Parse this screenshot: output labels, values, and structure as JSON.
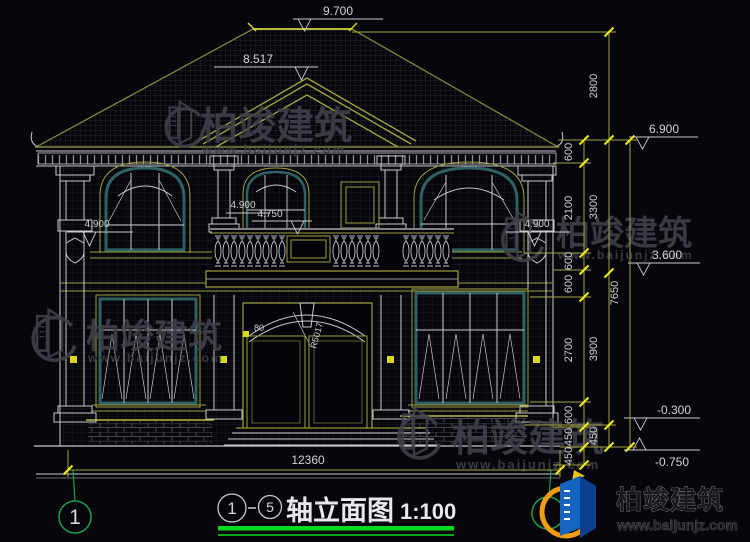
{
  "title_block": {
    "axis_from": "1",
    "axis_to": "5",
    "title": "轴立面图",
    "scale": "1:100"
  },
  "axis_left": "1",
  "elevations": {
    "ridge": "9.700",
    "gable": "8.517",
    "eave": "6.900",
    "sill_left": "4.900",
    "center_upper": "4.900",
    "center_lower": "4.750",
    "sill_right": "4.900",
    "second_floor": "3.600",
    "grade_a": "-0.300",
    "grade_b": "-0.750"
  },
  "dims": {
    "width_total": "12360",
    "roof": "2800",
    "inner": [
      "600",
      "2100",
      "600",
      "600",
      "2700",
      "600",
      "450",
      "450"
    ],
    "mid": [
      "3300",
      "3900",
      "450"
    ],
    "total": "7650",
    "door_radius": "R5017",
    "door_width": "80"
  },
  "watermark": {
    "company": "柏竣建筑",
    "website": "www.baijunjz.com"
  },
  "brand": {
    "company": "柏竣建筑",
    "website": "www.baijunjz.com"
  },
  "colors": {
    "background": "#06060c",
    "dim_line_olive": "#a3a340",
    "tick_yellow": "#ecec1a",
    "window_teal": "#2e6161",
    "axis_green": "#1b9e4c",
    "title_underline_green": "#0ad81c",
    "line_white": "#c9c9ce",
    "brand_blue": "#1565c0",
    "brand_dark_blue": "#0d3f8f",
    "brand_orange": "#ef9c14"
  }
}
